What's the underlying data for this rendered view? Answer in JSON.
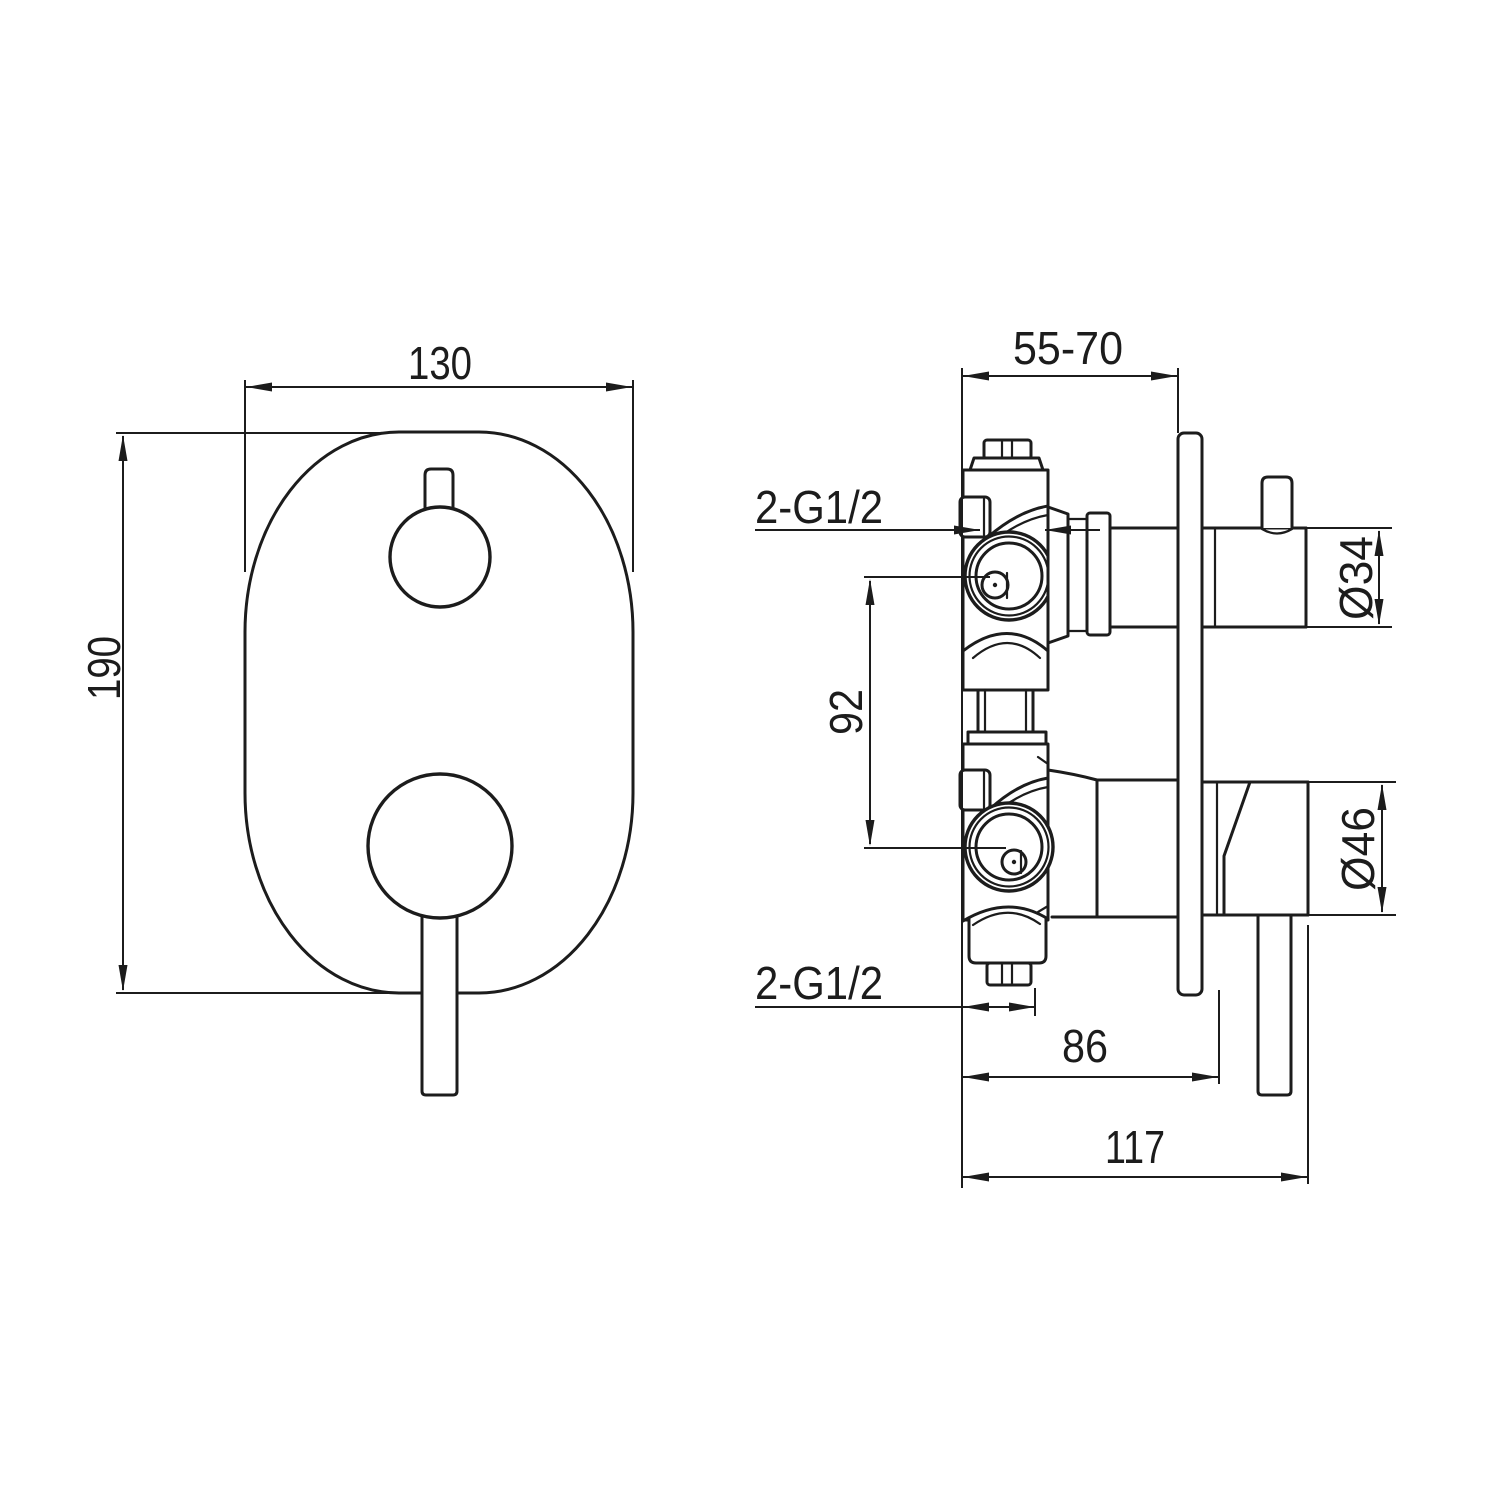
{
  "drawing": {
    "colors": {
      "line": "#1c1c1c",
      "background": "#ffffff"
    },
    "front_view": {
      "width": "130",
      "height": "190"
    },
    "side_view": {
      "depth_range": "55-70",
      "inlet_top": "2-G1/2",
      "inlet_bottom": "2-G1/2",
      "port_center_distance": "92",
      "top_handle_diameter": "Ø34",
      "bottom_handle_diameter": "Ø46",
      "handle_offset": "86",
      "overall_projection": "117"
    }
  }
}
